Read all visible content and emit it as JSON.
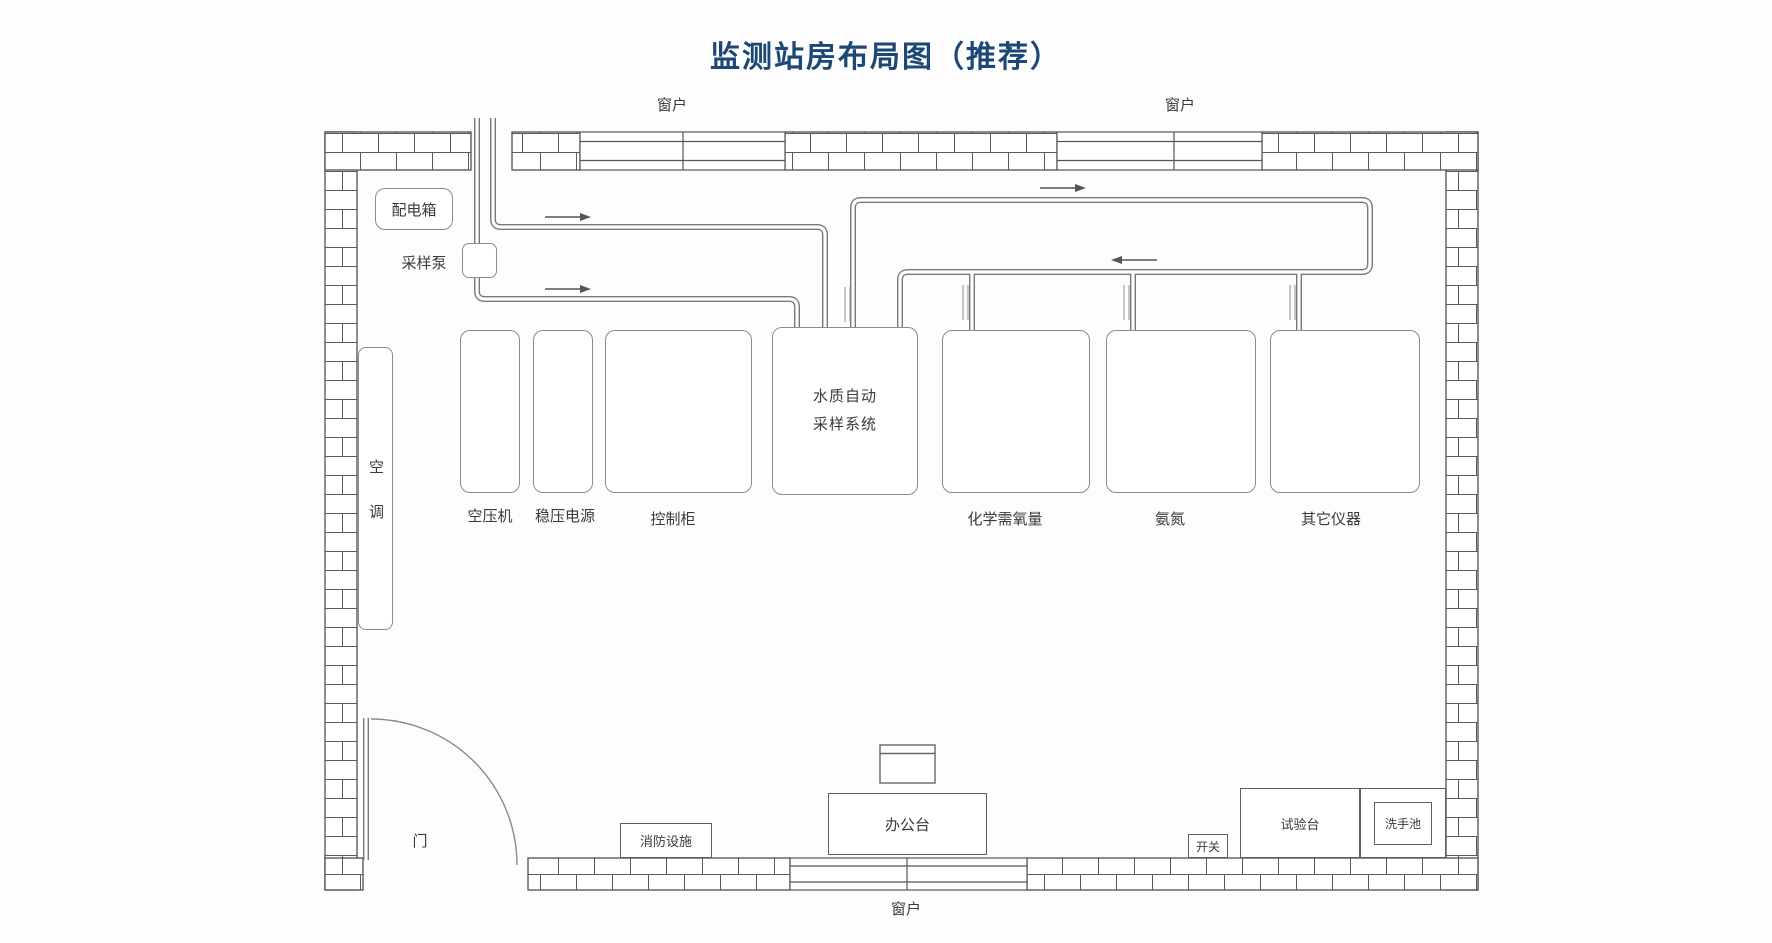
{
  "title": "监测站房布局图（推荐）",
  "labels": {
    "window": "窗户",
    "door": "门",
    "distribution_box": "配电箱",
    "sampling_pump": "采样泵",
    "air_conditioner": "空调",
    "fire_equipment": "消防设施",
    "office_desk": "办公台",
    "power_switch": "开关",
    "test_bench": "试验台",
    "sink": "洗手池"
  },
  "equipment": {
    "air_compressor": "空压机",
    "voltage_stabilizer": "稳压电源",
    "control_cabinet": "控制柜",
    "water_sampling_system": "水质自动采样系统",
    "cod_analyzer": "化学需氧量",
    "ammonia_analyzer": "氨氮",
    "other_instruments": "其它仪器"
  },
  "colors": {
    "title_text": "#1d4876",
    "wall_line": "#4f4f4f",
    "pipe_line": "#787878",
    "label_text": "#3a3a3a",
    "background": "#fdfdfd"
  }
}
